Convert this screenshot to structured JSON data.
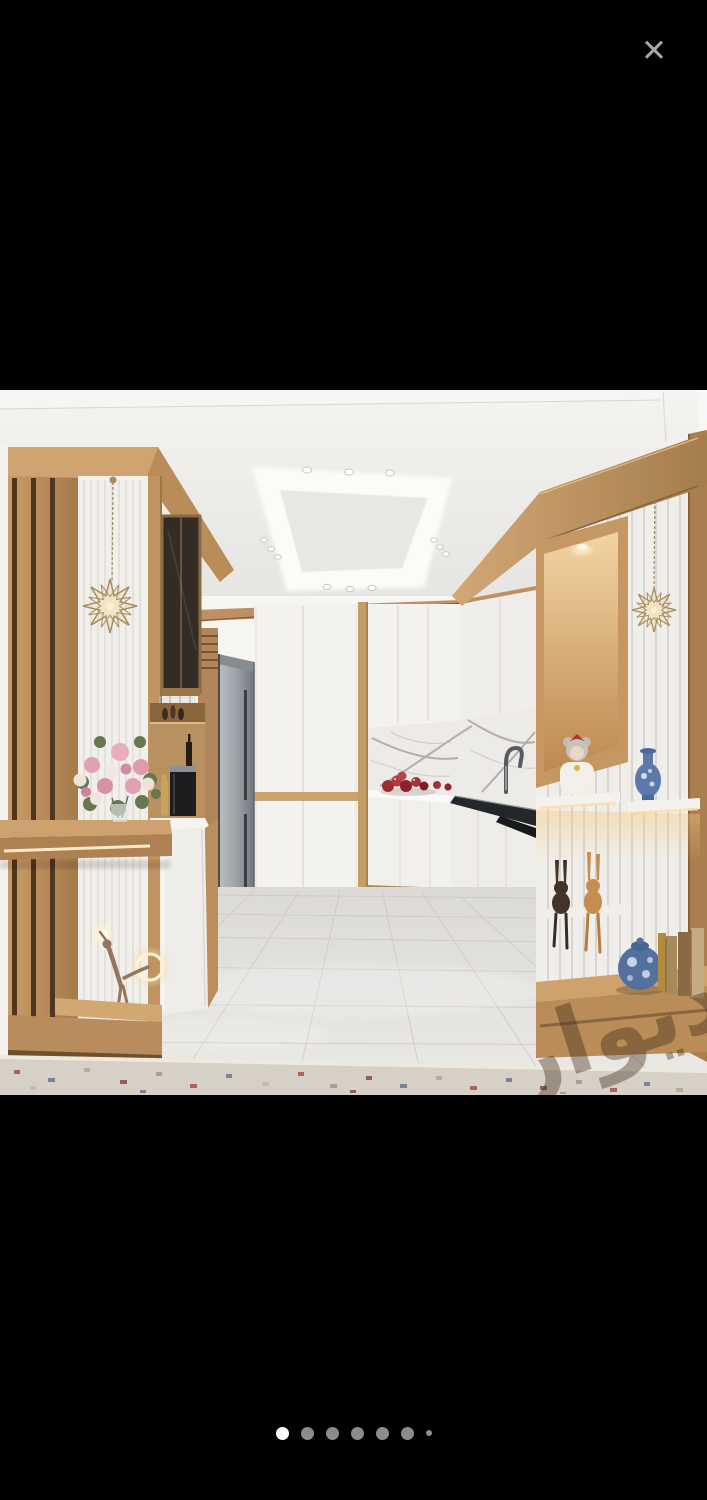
{
  "viewer": {
    "close_icon": "✕",
    "background_color": "#000000"
  },
  "photo": {
    "kind": "listing-photo",
    "alt": "3D render of a modern kitchen: white cabinets with gold trim, wood slat partitions with lit display shelves, marble backsplash, stainless refrigerator, cove-lit ceiling, glossy tile floor with patterned rug",
    "watermark_text": "دیوار",
    "colors": {
      "wood": "#c29562",
      "cabinets": "#f3f1ee",
      "ceiling": "#e9e7e4",
      "floor": "#e2e0dd",
      "warm_glow": "#ffe9c2",
      "steel": "#9aa0a5",
      "marble_vein": "#a59f98"
    }
  },
  "carousel": {
    "total_dots": 7,
    "active_index": 0,
    "dot_color_active": "#ffffff",
    "dot_color_inactive": "#8c8c8c",
    "last_dot_small": true
  }
}
